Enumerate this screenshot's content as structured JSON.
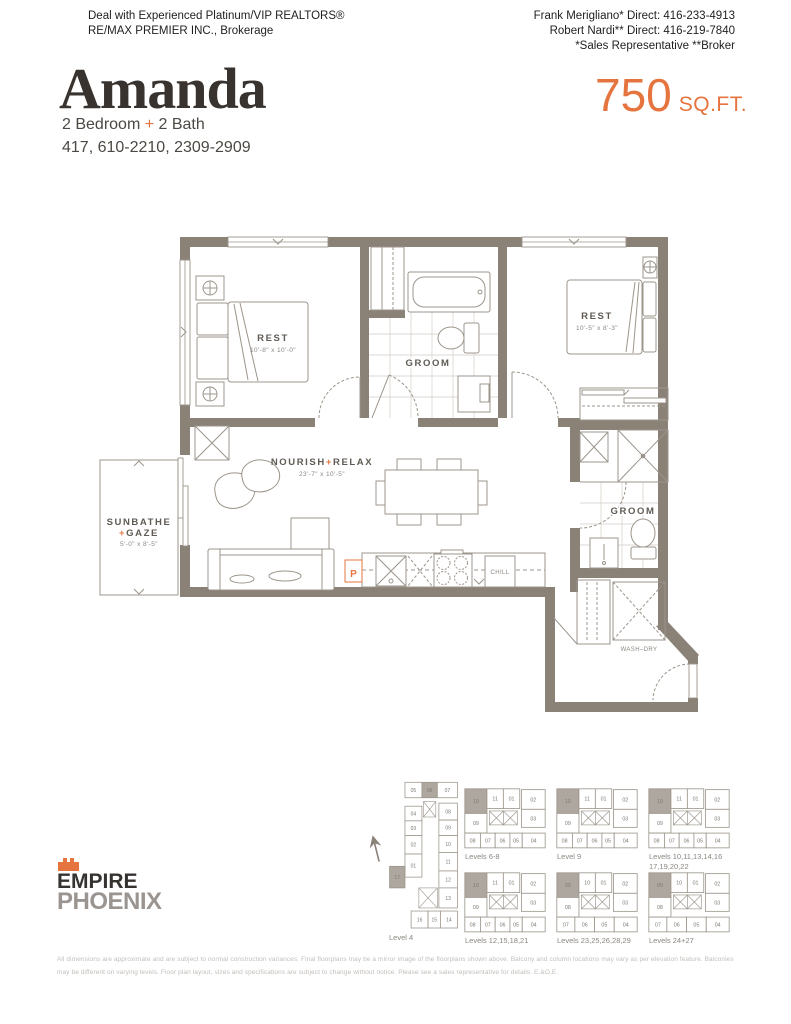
{
  "header": {
    "left_line1": "Deal with Experienced Platinum/VIP REALTORS®",
    "left_line2": "RE/MAX PREMIER INC., Brokerage",
    "right_line1": "Frank Merigliano* Direct: 416-233-4913",
    "right_line2": "Robert Nardi** Direct: 416-219-7840",
    "right_line3": "*Sales Representative **Broker"
  },
  "title_block": {
    "name": "Amanda",
    "sqft_value": "750",
    "sqft_unit": "SQ.FT.",
    "bed_bath": {
      "part1": "2 Bedroom ",
      "plus": "+",
      "part2": " 2 Bath"
    },
    "unit_numbers": "417, 610-2210, 2309-2909"
  },
  "floorplan": {
    "rooms": {
      "rest1": {
        "name": "REST",
        "dim": "10'-8\" x 10'-0\""
      },
      "groom1": {
        "name": "GROOM"
      },
      "rest2": {
        "name": "REST",
        "dim": "10'-5\" x 8'-3\""
      },
      "groom2": {
        "name": "GROOM"
      },
      "living": {
        "part1": "NOURISH",
        "plus": "+",
        "part2": "RELAX",
        "dim": "23'-7\" x 10'-5\""
      },
      "balcony": {
        "line1": "SUNBATHE",
        "plus": "+",
        "line2": "GAZE",
        "dim": "5'-0\" x 8'-5\""
      },
      "laundry": {
        "name": "WASH–DRY"
      },
      "fridge": {
        "name": "CHILL"
      },
      "pantry": {
        "name": "P"
      }
    }
  },
  "logo": {
    "name_line1": "EMPIRE",
    "name_line2": "PHOENIX"
  },
  "keyplans": {
    "plans": [
      {
        "label": "Level 4",
        "type": "tall",
        "units": [
          "05",
          "06",
          "07",
          "04",
          "03",
          "02",
          "01",
          "08",
          "09",
          "10",
          "11",
          "12",
          "13",
          "17",
          "16",
          "15",
          "14"
        ],
        "highlight": [
          "06",
          "17"
        ]
      },
      {
        "label": "Levels 6-8",
        "type": "wideA",
        "units": [
          "10",
          "11",
          "01",
          "02",
          "09",
          "03",
          "08",
          "07",
          "06",
          "05",
          "04"
        ],
        "highlight": [
          "10"
        ]
      },
      {
        "label": "Level 9",
        "type": "wideA",
        "units": [
          "10",
          "11",
          "01",
          "02",
          "09",
          "03",
          "08",
          "07",
          "06",
          "05",
          "04"
        ],
        "highlight": [
          "10"
        ]
      },
      {
        "label": "Levels 10,11,13,14,16",
        "label2": "17,19,20,22",
        "type": "wideA",
        "units": [
          "10",
          "11",
          "01",
          "02",
          "09",
          "03",
          "08",
          "07",
          "06",
          "05",
          "04"
        ],
        "highlight": [
          "10"
        ]
      },
      {
        "label": "Levels 12,15,18,21",
        "type": "wideA",
        "units": [
          "10",
          "11",
          "01",
          "02",
          "09",
          "03",
          "08",
          "07",
          "06",
          "05",
          "04"
        ],
        "highlight": [
          "10"
        ]
      },
      {
        "label": "Levels 23,25,26,28,29",
        "type": "wideB",
        "units": [
          "09",
          "10",
          "01",
          "02",
          "08",
          "03",
          "07",
          "06",
          "05",
          "04"
        ],
        "highlight": [
          "09"
        ]
      },
      {
        "label": "Levels 24+27",
        "type": "wideB",
        "units": [
          "09",
          "10",
          "01",
          "02",
          "08",
          "03",
          "07",
          "06",
          "05",
          "04"
        ],
        "highlight": [
          "09"
        ]
      }
    ]
  },
  "disclaimer": {
    "text": "All dimensions are approximate and are subject to normal construction variances. Final floorplans may be a mirror image of the floorplans shown above. Balcony and column locations may vary as per elevation feature. Balconies may be different on varying levels. Floor plan layout, sizes and specifications are subject to change without notice. Please see a sales representative for details. E.&O.E."
  },
  "colors": {
    "accent": "#E5743F",
    "wall": "#8A8177",
    "line": "#9C958B",
    "shaded_unit": "#AEA79F"
  }
}
